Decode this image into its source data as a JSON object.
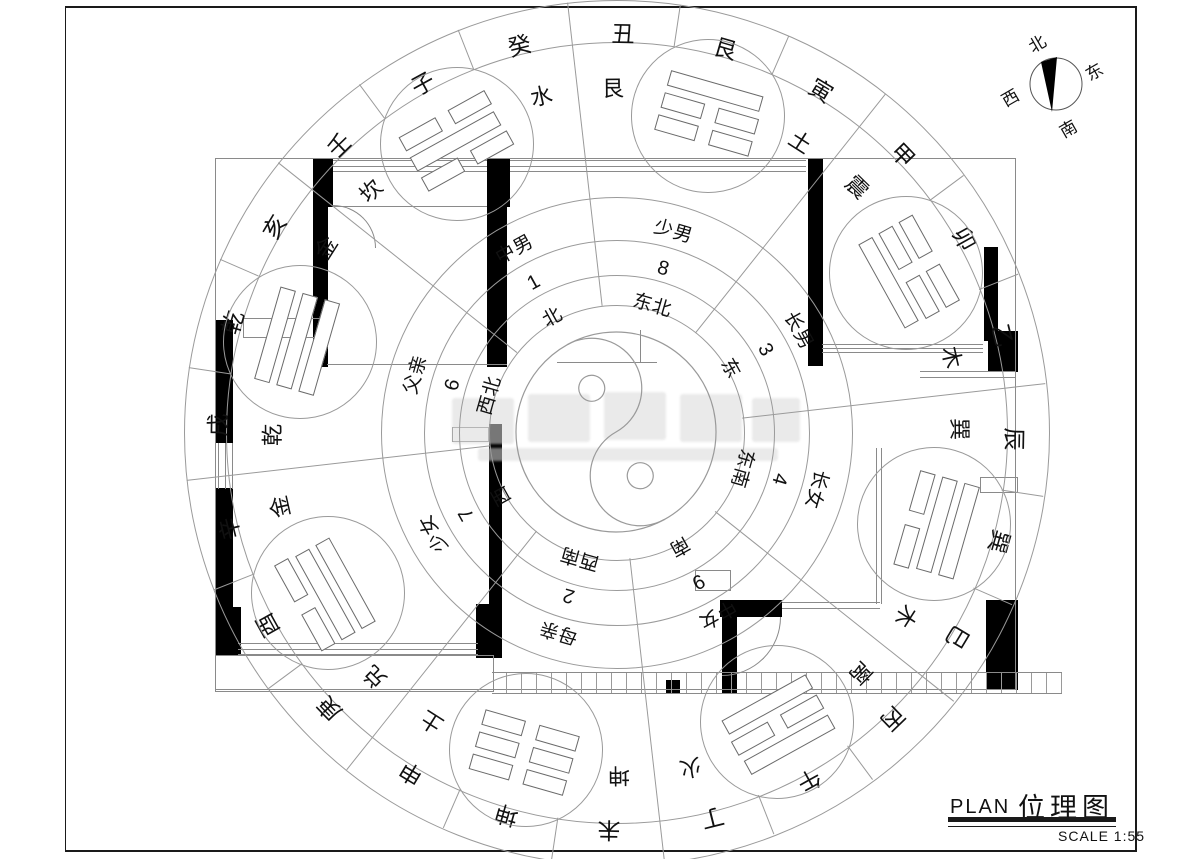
{
  "title_block": {
    "plan_label": "PLAN",
    "title": "位理图",
    "scale_label": "SCALE 1:55"
  },
  "north_arrow": {
    "north": "北",
    "east": "东",
    "west": "西",
    "south": "南"
  },
  "luopan": {
    "rotation_deg": -29,
    "sectors": [
      {
        "angle": 0,
        "direction": "北",
        "number": "1",
        "family": "中男",
        "trigram": "kan",
        "lines": [
          0,
          1,
          0
        ]
      },
      {
        "angle": 45,
        "direction": "东北",
        "number": "8",
        "family": "少男",
        "trigram": "gen",
        "lines": [
          1,
          0,
          0
        ]
      },
      {
        "angle": 90,
        "direction": "东",
        "number": "3",
        "family": "长男",
        "trigram": "zhen",
        "lines": [
          0,
          0,
          1
        ]
      },
      {
        "angle": 135,
        "direction": "东南",
        "number": "4",
        "family": "长女",
        "trigram": "xun",
        "lines": [
          1,
          1,
          0
        ]
      },
      {
        "angle": 180,
        "direction": "南",
        "number": "9",
        "family": "中女",
        "trigram": "li",
        "lines": [
          1,
          0,
          1
        ]
      },
      {
        "angle": 225,
        "direction": "西南",
        "number": "2",
        "family": "母亲",
        "trigram": "kun",
        "lines": [
          0,
          0,
          0
        ]
      },
      {
        "angle": 270,
        "direction": "西",
        "number": "7",
        "family": "少女",
        "trigram": "dui",
        "lines": [
          0,
          1,
          1
        ]
      },
      {
        "angle": 315,
        "direction": "西北",
        "number": "6",
        "family": "父亲",
        "trigram": "qian",
        "lines": [
          1,
          1,
          1
        ]
      }
    ],
    "boundary_pairs": [
      {
        "angle": 22.5,
        "element": "水",
        "trigram_name": "艮"
      },
      {
        "angle": 67.5,
        "element": "土",
        "trigram_name": "震"
      },
      {
        "angle": 112.5,
        "element": "木",
        "trigram_name": "巽"
      },
      {
        "angle": 157.5,
        "element": "木",
        "trigram_name": "离"
      },
      {
        "angle": 202.5,
        "element": "火",
        "trigram_name": "坤"
      },
      {
        "angle": 247.5,
        "element": "土",
        "trigram_name": "兑"
      },
      {
        "angle": 292.5,
        "element": "金",
        "trigram_name": "乾"
      },
      {
        "angle": 337.5,
        "element": "金",
        "trigram_name": "坎"
      }
    ],
    "ring24": [
      "子",
      "癸",
      "丑",
      "艮",
      "寅",
      "甲",
      "卯",
      "乙",
      "辰",
      "巽",
      "巳",
      "丙",
      "午",
      "丁",
      "未",
      "坤",
      "申",
      "庚",
      "酉",
      "辛",
      "戌",
      "乾",
      "亥",
      "壬"
    ]
  },
  "floor_plan": {
    "walls": [
      [
        313,
        158,
        20,
        49
      ],
      [
        313,
        207,
        15,
        160
      ],
      [
        487,
        158,
        23,
        49
      ],
      [
        487,
        207,
        20,
        160
      ],
      [
        808,
        158,
        15,
        208
      ],
      [
        984,
        247,
        14,
        94
      ],
      [
        988,
        331,
        30,
        41
      ],
      [
        215,
        320,
        18,
        123
      ],
      [
        215,
        488,
        18,
        120
      ],
      [
        216,
        607,
        25,
        48
      ],
      [
        476,
        604,
        26,
        54
      ],
      [
        489,
        424,
        13,
        181
      ],
      [
        986,
        600,
        32,
        90
      ],
      [
        720,
        600,
        62,
        17
      ],
      [
        722,
        617,
        15,
        76
      ],
      [
        666,
        680,
        14,
        13
      ]
    ],
    "lines": [
      [
        215,
        158,
        801,
        1
      ],
      [
        215,
        158,
        1,
        532
      ],
      [
        1015,
        158,
        1,
        532
      ],
      [
        215,
        689,
        801,
        1
      ],
      [
        333,
        206,
        154,
        1
      ],
      [
        327,
        364,
        180,
        1
      ],
      [
        557,
        362,
        100,
        1
      ],
      [
        640,
        330,
        1,
        33
      ],
      [
        920,
        371,
        96,
        1
      ],
      [
        920,
        377,
        96,
        1
      ],
      [
        876,
        448,
        1,
        156
      ],
      [
        881,
        448,
        1,
        156
      ],
      [
        782,
        602,
        98,
        1
      ],
      [
        782,
        608,
        98,
        1
      ]
    ],
    "thin_rects": [
      [
        215,
        655,
        277,
        35
      ],
      [
        243,
        318,
        80,
        18
      ],
      [
        452,
        427,
        35,
        13
      ],
      [
        695,
        570,
        34,
        19
      ],
      [
        980,
        477,
        36,
        14
      ]
    ],
    "windows3": [
      {
        "box": [
          333,
          160,
          154,
          11
        ],
        "o": "h"
      },
      {
        "box": [
          510,
          160,
          296,
          11
        ],
        "o": "h"
      },
      {
        "box": [
          238,
          643,
          240,
          11
        ],
        "o": "h"
      },
      {
        "box": [
          822,
          344,
          161,
          8
        ],
        "o": "h"
      },
      {
        "box": [
          218,
          443,
          14,
          46
        ],
        "o": "v"
      }
    ],
    "hatch_strips": [
      [
        492,
        672,
        570,
        20
      ]
    ],
    "door_arcs": [
      {
        "box": [
          333,
          205,
          42,
          42
        ],
        "corner": "tr"
      },
      {
        "box": [
          722,
          617,
          58,
          58
        ],
        "corner": "br"
      }
    ]
  }
}
